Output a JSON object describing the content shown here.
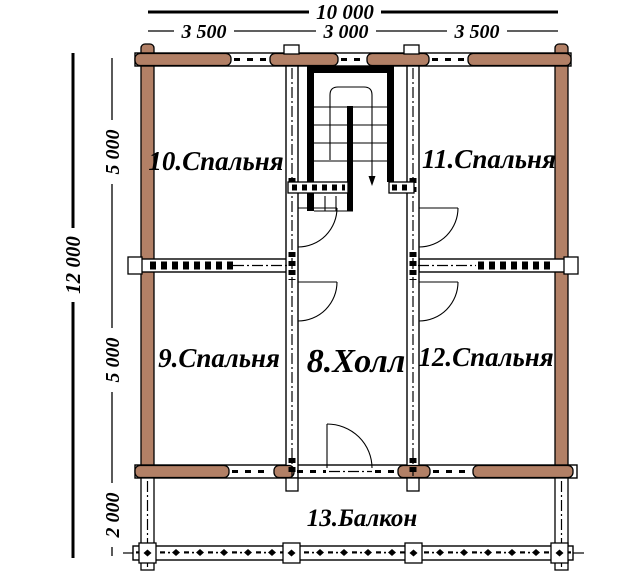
{
  "drawing": {
    "rooms": {
      "bedroom10": "10.Спальня",
      "bedroom11": "11.Спальня",
      "bedroom9": "9.Спальня",
      "hall": "8.Холл",
      "bedroom12": "12.Спальня",
      "balcony": "13.Балкон"
    },
    "dimensions": {
      "top_overall": "10 000",
      "top_segments": [
        "3 500",
        "3 000",
        "3 500"
      ],
      "left_overall": "12 000",
      "left_segments": [
        "5 000",
        "5 000",
        "2 000"
      ]
    },
    "colors": {
      "log_wall": "#b28066",
      "line": "#000000",
      "background": "#ffffff"
    }
  }
}
